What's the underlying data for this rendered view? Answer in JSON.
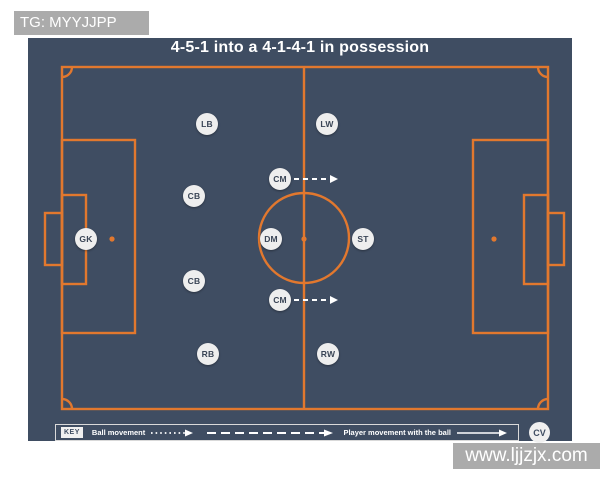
{
  "overlays": {
    "top_watermark": "TG: MYYJJPP",
    "bottom_watermark": "www.ljjzjx.com"
  },
  "board": {
    "title": "4-5-1 into a 4-1-4-1 in possession"
  },
  "pitch": {
    "players": [
      {
        "label": "GK",
        "x": 86,
        "y": 239
      },
      {
        "label": "LB",
        "x": 207,
        "y": 124
      },
      {
        "label": "CB",
        "x": 194,
        "y": 196
      },
      {
        "label": "CB",
        "x": 194,
        "y": 281
      },
      {
        "label": "RB",
        "x": 208,
        "y": 354
      },
      {
        "label": "CM",
        "x": 280,
        "y": 179
      },
      {
        "label": "DM",
        "x": 271,
        "y": 239
      },
      {
        "label": "CM",
        "x": 280,
        "y": 300
      },
      {
        "label": "LW",
        "x": 327,
        "y": 124
      },
      {
        "label": "ST",
        "x": 363,
        "y": 239
      },
      {
        "label": "RW",
        "x": 328,
        "y": 354
      }
    ],
    "movement_arrows": [
      {
        "x1": 294,
        "y1": 179,
        "x2": 338,
        "y2": 179,
        "style": "dashed"
      },
      {
        "x1": 294,
        "y1": 300,
        "x2": 338,
        "y2": 300,
        "style": "dashed"
      }
    ]
  },
  "key": {
    "tag": "KEY",
    "ball_movement_label": "Ball movement",
    "player_movement_label": "Player movement with the ball"
  },
  "badge": "CV",
  "colors": {
    "canvas_bg": "#3f4d62",
    "line": "#e2782e",
    "player_bg": "#eeeeee",
    "player_text": "#3a4556",
    "watermark_bg": "#ababab",
    "key_border": "#d9d9d9",
    "white": "#ffffff"
  }
}
